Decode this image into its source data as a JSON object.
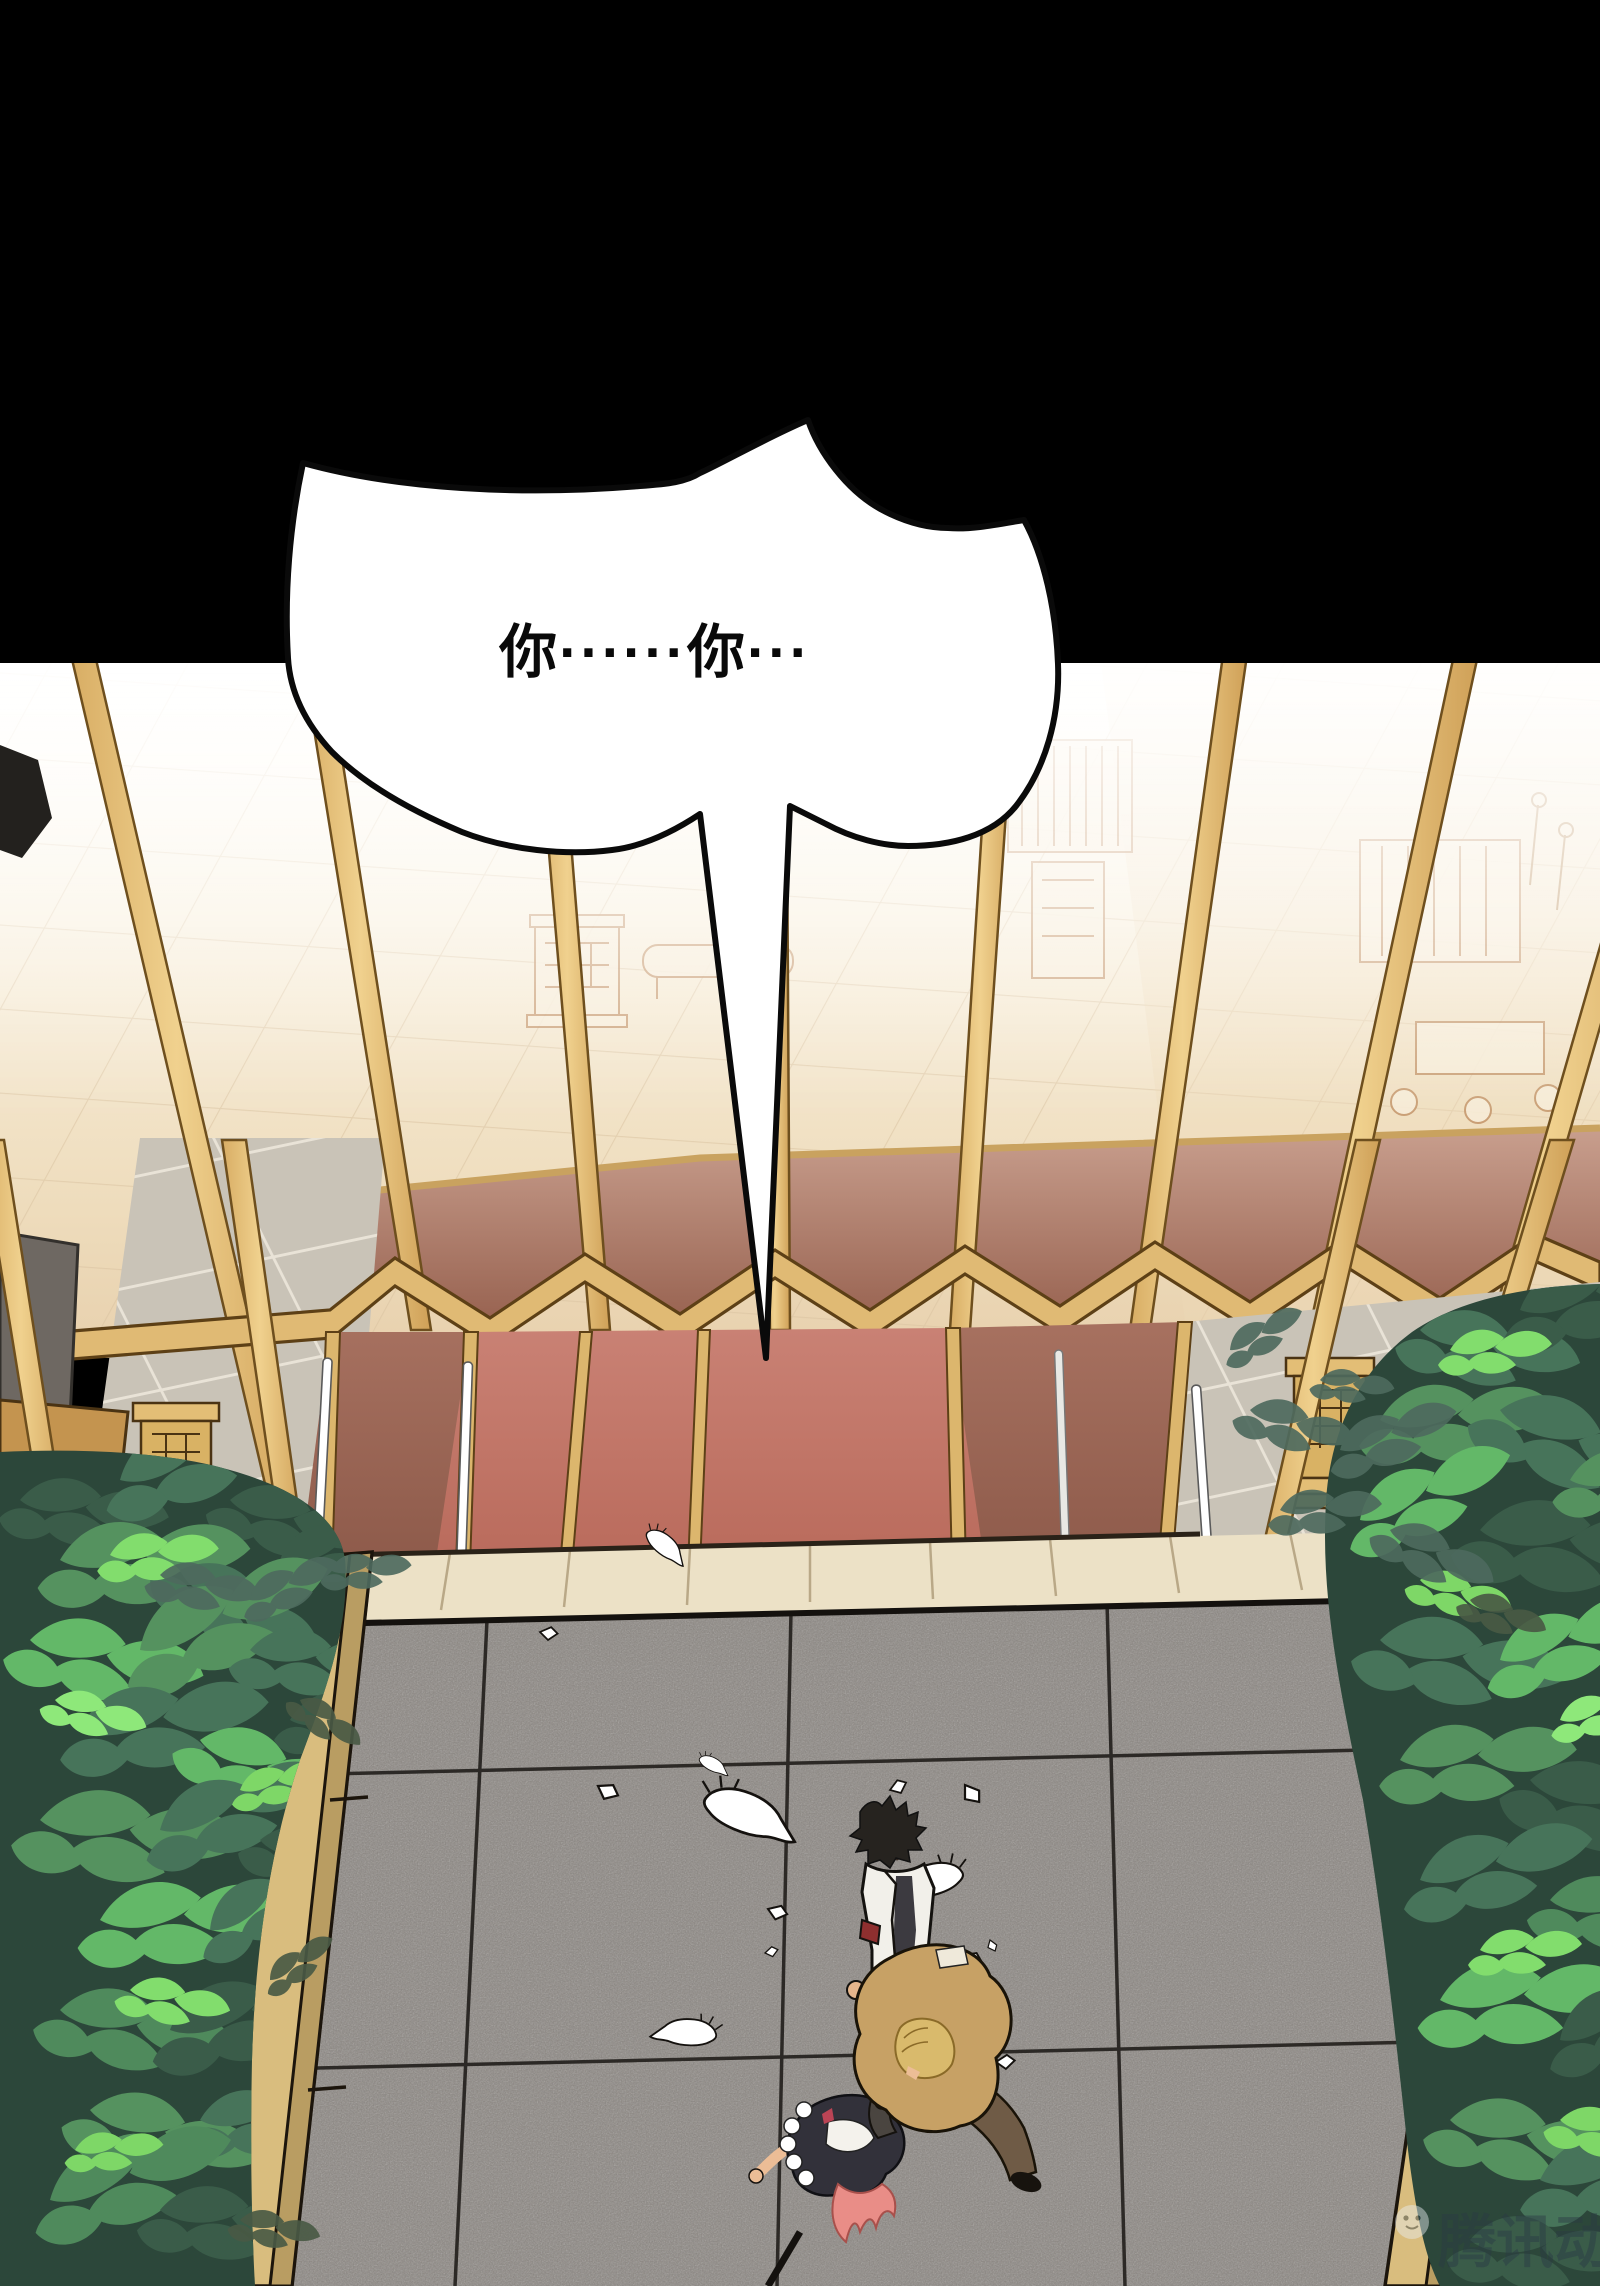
{
  "page": {
    "type": "comic-panel",
    "width": 1600,
    "height": 2286,
    "background": "#000000"
  },
  "speech_bubble": {
    "text": "你······你···",
    "fill": "#ffffff",
    "outline": "#0a0a0a",
    "tail_direction": "down-to-courtyard"
  },
  "watermark": {
    "text": "腾讯动漫",
    "logo": "penguin-mascot-icon"
  },
  "palette": {
    "gutter_black": "#000000",
    "gold_frame": "#e7c47c",
    "gold_frame_dark": "#6e4f1e",
    "interior_floor": "#f3e7cf",
    "maroon_wall": "#9c6753",
    "carpet_red": "#bf7365",
    "stone_gray": "#c9c3b7",
    "walkway_cream": "#ece1c6",
    "courtyard_gray": "#8b8681",
    "bush_dark": "#2c473a",
    "bush_bright": "#7ed767",
    "planter_tan": "#d9bd7e",
    "hair_black": "#26231f",
    "jacket_white": "#f2f0ea",
    "coat_tan": "#c7a165",
    "hair_blonde": "#d9ba6c",
    "hair_pink": "#e98d87",
    "armband_red": "#8e2f2f",
    "radish_white": "#ffffff"
  }
}
